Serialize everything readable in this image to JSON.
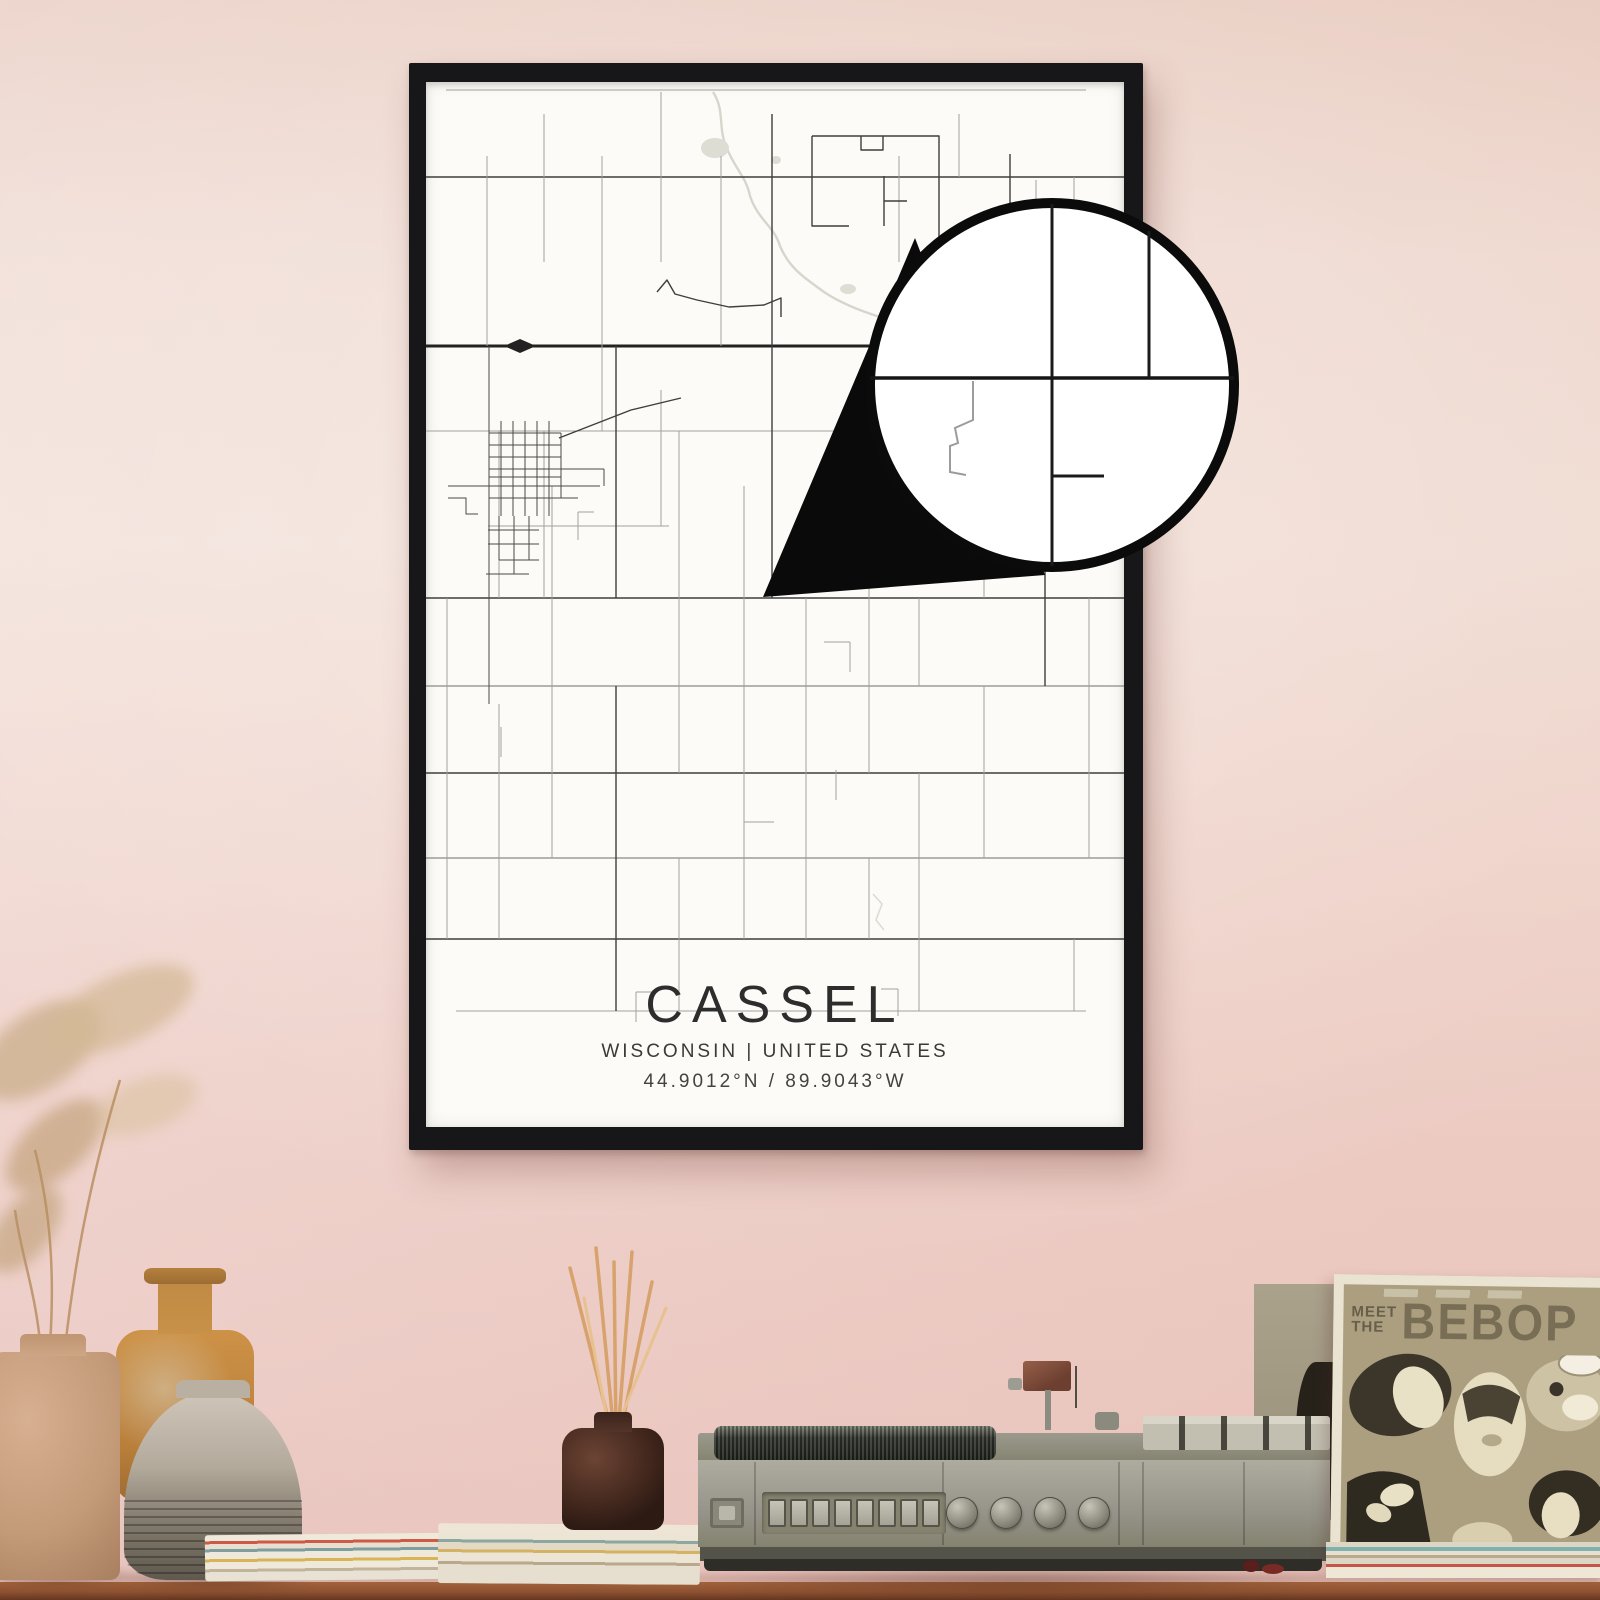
{
  "poster": {
    "title": "CASSEL",
    "subtitle": "WISCONSIN | UNITED STATES",
    "coordinates": "44.9012°N / 89.9043°W",
    "frame_color": "#17171a",
    "paper_color": "#fcfbf7"
  },
  "map": {
    "type": "map",
    "road_colors": {
      "highway": "#222222",
      "major": "#3e3e3e",
      "minor": "#a0a09c",
      "town": "#4a4a4a",
      "river": "#d8d5cd"
    },
    "features": [
      {
        "t": "halo",
        "p": [
          115,
          848,
          476,
          166
        ]
      },
      {
        "t": "path",
        "c": "riv",
        "d": "M287,10 C299,28 292,46 300,64 C308,86 320,94 324,114 C332,138 348,144 354,164 C364,188 382,198 398,210 C416,222 438,230 454,235"
      },
      {
        "t": "pl",
        "c": "rivf",
        "p": "447,812 456,822 450,838 458,848"
      },
      {
        "t": "e",
        "c": "pond",
        "p": [
          289,
          66,
          14,
          10
        ]
      },
      {
        "t": "e",
        "c": "pond",
        "p": [
          350,
          78,
          5,
          4
        ]
      },
      {
        "t": "e",
        "c": "pond",
        "p": [
          422,
          207,
          8,
          5
        ]
      },
      {
        "t": "e",
        "c": "pond",
        "p": [
          455,
          240,
          4,
          3
        ]
      },
      {
        "t": "l",
        "c": "min",
        "p": [
          20,
          8,
          660,
          8
        ]
      },
      {
        "t": "l",
        "c": "maj",
        "p": [
          0,
          95,
          698,
          95
        ]
      },
      {
        "t": "l",
        "c": "hwy",
        "p": [
          0,
          264,
          698,
          264
        ]
      },
      {
        "t": "pg",
        "c": "hwyf",
        "p": "78,264 94,257 110,264 94,271"
      },
      {
        "t": "l",
        "c": "min",
        "p": [
          0,
          349,
          460,
          349
        ]
      },
      {
        "t": "l",
        "c": "min",
        "p": [
          540,
          349,
          698,
          349
        ]
      },
      {
        "t": "l",
        "c": "min",
        "p": [
          62,
          444,
          243,
          444
        ]
      },
      {
        "t": "l",
        "c": "maj",
        "p": [
          0,
          516,
          698,
          516
        ]
      },
      {
        "t": "l",
        "c": "mid",
        "p": [
          0,
          604,
          698,
          604
        ]
      },
      {
        "t": "l",
        "c": "maj",
        "p": [
          0,
          691,
          698,
          691
        ]
      },
      {
        "t": "l",
        "c": "mid",
        "p": [
          0,
          776,
          698,
          776
        ]
      },
      {
        "t": "l",
        "c": "maj",
        "p": [
          0,
          857,
          698,
          857
        ]
      },
      {
        "t": "l",
        "c": "min",
        "p": [
          30,
          929,
          660,
          929
        ]
      },
      {
        "t": "l",
        "c": "min",
        "p": [
          61,
          74,
          61,
          264
        ]
      },
      {
        "t": "l",
        "c": "min",
        "p": [
          118,
          32,
          118,
          180
        ]
      },
      {
        "t": "l",
        "c": "min",
        "p": [
          118,
          349,
          118,
          516
        ]
      },
      {
        "t": "l",
        "c": "min",
        "p": [
          176,
          74,
          176,
          349
        ]
      },
      {
        "t": "l",
        "c": "min",
        "p": [
          235,
          10,
          235,
          180
        ]
      },
      {
        "t": "l",
        "c": "min",
        "p": [
          235,
          308,
          235,
          444
        ]
      },
      {
        "t": "l",
        "c": "min",
        "p": [
          295,
          74,
          295,
          264
        ]
      },
      {
        "t": "l",
        "c": "maj",
        "p": [
          346,
          32,
          346,
          516
        ]
      },
      {
        "t": "l",
        "c": "min",
        "p": [
          473,
          74,
          473,
          180
        ]
      },
      {
        "t": "l",
        "c": "min",
        "p": [
          533,
          32,
          533,
          95
        ]
      },
      {
        "t": "l",
        "c": "maj",
        "p": [
          584,
          72,
          584,
          264
        ]
      },
      {
        "t": "l",
        "c": "min",
        "p": [
          648,
          95,
          648,
          308
        ]
      },
      {
        "t": "l",
        "c": "min",
        "p": [
          21,
          516,
          21,
          857
        ]
      },
      {
        "t": "l",
        "c": "min",
        "p": [
          73,
          349,
          73,
          516
        ]
      },
      {
        "t": "l",
        "c": "min",
        "p": [
          73,
          622,
          73,
          857
        ]
      },
      {
        "t": "l",
        "c": "min",
        "p": [
          126,
          404,
          126,
          776
        ]
      },
      {
        "t": "l",
        "c": "maj",
        "p": [
          190,
          264,
          190,
          516
        ]
      },
      {
        "t": "l",
        "c": "maj",
        "p": [
          190,
          604,
          190,
          929
        ]
      },
      {
        "t": "l",
        "c": "min",
        "p": [
          253,
          349,
          253,
          691
        ]
      },
      {
        "t": "l",
        "c": "min",
        "p": [
          253,
          776,
          253,
          929
        ]
      },
      {
        "t": "l",
        "c": "min",
        "p": [
          318,
          404,
          318,
          857
        ]
      },
      {
        "t": "l",
        "c": "min",
        "p": [
          380,
          516,
          380,
          857
        ]
      },
      {
        "t": "l",
        "c": "min",
        "p": [
          443,
          349,
          443,
          691
        ]
      },
      {
        "t": "l",
        "c": "min",
        "p": [
          443,
          776,
          443,
          857
        ]
      },
      {
        "t": "l",
        "c": "min",
        "p": [
          493,
          264,
          493,
          404
        ]
      },
      {
        "t": "l",
        "c": "min",
        "p": [
          493,
          516,
          493,
          604
        ]
      },
      {
        "t": "l",
        "c": "min",
        "p": [
          493,
          691,
          493,
          929
        ]
      },
      {
        "t": "l",
        "c": "min",
        "p": [
          558,
          349,
          558,
          516
        ]
      },
      {
        "t": "l",
        "c": "min",
        "p": [
          558,
          604,
          558,
          776
        ]
      },
      {
        "t": "l",
        "c": "maj",
        "p": [
          619,
          264,
          619,
          604
        ]
      },
      {
        "t": "l",
        "c": "min",
        "p": [
          663,
          516,
          663,
          776
        ]
      },
      {
        "t": "l",
        "c": "min",
        "p": [
          648,
          857,
          648,
          929
        ]
      },
      {
        "t": "pl",
        "c": "maj",
        "p": "386,54 513,54 513,179"
      },
      {
        "t": "pl",
        "c": "maj",
        "p": "386,54 386,144 423,144"
      },
      {
        "t": "pl",
        "c": "maj",
        "p": "435,54 435,68 457,68 457,54"
      },
      {
        "t": "l",
        "c": "maj",
        "p": [
          458,
          94,
          458,
          144
        ]
      },
      {
        "t": "l",
        "c": "maj",
        "p": [
          458,
          119,
          481,
          119
        ]
      },
      {
        "t": "pl",
        "c": "maj",
        "p": "231,210 241,198 249,212 271,218 303,225 338,223 355,216 355,235"
      },
      {
        "t": "pl",
        "c": "maj",
        "p": "133,356 205,328 255,316"
      },
      {
        "t": "l",
        "c": "twn",
        "p": [
          63,
          264,
          63,
          622
        ]
      },
      {
        "t": "l",
        "c": "twn",
        "p": [
          22,
          404,
          174,
          404
        ]
      },
      {
        "t": "l",
        "c": "twn",
        "p": [
          75,
          339,
          75,
          434
        ]
      },
      {
        "t": "l",
        "c": "twn",
        "p": [
          87,
          339,
          87,
          434
        ]
      },
      {
        "t": "l",
        "c": "twn",
        "p": [
          99,
          339,
          99,
          434
        ]
      },
      {
        "t": "l",
        "c": "twn",
        "p": [
          111,
          339,
          111,
          434
        ]
      },
      {
        "t": "l",
        "c": "twn",
        "p": [
          123,
          339,
          123,
          434
        ]
      },
      {
        "t": "l",
        "c": "twn",
        "p": [
          135,
          351,
          135,
          416
        ]
      },
      {
        "t": "l",
        "c": "twn",
        "p": [
          63,
          351,
          135,
          351
        ]
      },
      {
        "t": "l",
        "c": "twn",
        "p": [
          63,
          363,
          135,
          363
        ]
      },
      {
        "t": "l",
        "c": "twn",
        "p": [
          63,
          375,
          135,
          375
        ]
      },
      {
        "t": "l",
        "c": "twn",
        "p": [
          63,
          387,
          135,
          387
        ]
      },
      {
        "t": "l",
        "c": "twn",
        "p": [
          63,
          395,
          135,
          395
        ]
      },
      {
        "t": "l",
        "c": "twn",
        "p": [
          63,
          416,
          152,
          416
        ]
      },
      {
        "t": "l",
        "c": "twn",
        "p": [
          73,
          434,
          73,
          478
        ]
      },
      {
        "t": "l",
        "c": "twn",
        "p": [
          88,
          434,
          88,
          492
        ]
      },
      {
        "t": "l",
        "c": "twn",
        "p": [
          103,
          434,
          103,
          478
        ]
      },
      {
        "t": "l",
        "c": "twn",
        "p": [
          62,
          448,
          113,
          448
        ]
      },
      {
        "t": "l",
        "c": "twn",
        "p": [
          62,
          462,
          113,
          462
        ]
      },
      {
        "t": "l",
        "c": "twn",
        "p": [
          73,
          478,
          113,
          478
        ]
      },
      {
        "t": "l",
        "c": "twn",
        "p": [
          60,
          492,
          103,
          492
        ]
      },
      {
        "t": "pl",
        "c": "twn",
        "p": "22,416 40,416 40,432 52,432"
      },
      {
        "t": "l",
        "c": "twn",
        "p": [
          135,
          387,
          178,
          387
        ]
      },
      {
        "t": "l",
        "c": "twn",
        "p": [
          178,
          387,
          178,
          404
        ]
      },
      {
        "t": "l",
        "c": "min",
        "p": [
          152,
          430,
          152,
          458
        ]
      },
      {
        "t": "l",
        "c": "min",
        "p": [
          152,
          430,
          168,
          430
        ]
      },
      {
        "t": "l",
        "c": "min",
        "p": [
          398,
          560,
          424,
          560
        ]
      },
      {
        "t": "l",
        "c": "min",
        "p": [
          424,
          560,
          424,
          590
        ]
      },
      {
        "t": "l",
        "c": "min",
        "p": [
          410,
          688,
          410,
          718
        ]
      },
      {
        "t": "l",
        "c": "min",
        "p": [
          318,
          740,
          348,
          740
        ]
      },
      {
        "t": "l",
        "c": "min",
        "p": [
          210,
          910,
          210,
          940
        ]
      },
      {
        "t": "l",
        "c": "min",
        "p": [
          210,
          910,
          230,
          910
        ]
      },
      {
        "t": "l",
        "c": "min",
        "p": [
          472,
          907,
          472,
          934
        ]
      },
      {
        "t": "l",
        "c": "min",
        "p": [
          455,
          907,
          472,
          907
        ]
      },
      {
        "t": "l",
        "c": "min",
        "p": [
          610,
          98,
          610,
          124
        ]
      },
      {
        "t": "l",
        "c": "min",
        "p": [
          596,
          124,
          610,
          124
        ]
      },
      {
        "t": "l",
        "c": "min",
        "p": [
          663,
          180,
          683,
          180
        ]
      },
      {
        "t": "l",
        "c": "min",
        "p": [
          663,
          180,
          663,
          202
        ]
      },
      {
        "t": "l",
        "c": "min",
        "p": [
          75,
          645,
          75,
          675
        ]
      }
    ]
  },
  "magnifier": {
    "circle": {
      "cx": 1052,
      "cy": 385,
      "r": 182,
      "ring_color": "#0b0b0b",
      "ring_width": 10,
      "fill": "#ffffff"
    },
    "tail_points": "763,597 915,238 1045,575",
    "lines": [
      {
        "t": "l",
        "c": "mgl",
        "p": [
          1052,
          204,
          1052,
          566
        ]
      },
      {
        "t": "l",
        "c": "mgl2",
        "p": [
          870,
          378,
          1234,
          378
        ]
      },
      {
        "t": "l",
        "c": "mgl",
        "p": [
          1149,
          231,
          1149,
          378
        ]
      },
      {
        "t": "l",
        "c": "mgl",
        "p": [
          1052,
          476,
          1104,
          476
        ]
      },
      {
        "t": "pl",
        "c": "mglt",
        "p": "973,381 973,420 955,428 958,443 950,446 950,472 966,475"
      }
    ]
  },
  "record_player": {
    "square_buttons": 8,
    "knobs": 4,
    "body_color": "#a3a296"
  },
  "vinyl": {
    "title_line1": "MEET",
    "title_line2": "THE",
    "title_line3": "BEBOP"
  },
  "scene_colors": {
    "wall_top": "#ebd2c8",
    "wall_mid": "#f2e0da",
    "wall_bottom": "#eac6c0",
    "table": "#8e5232"
  }
}
